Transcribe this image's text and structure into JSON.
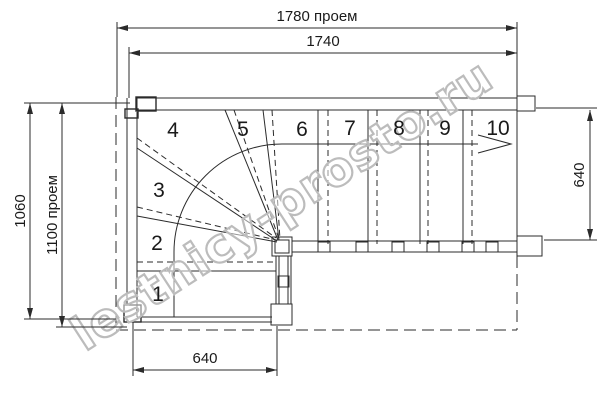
{
  "drawing": {
    "type": "staircase-floor-plan",
    "watermark": "lestnicy-prosto.ru",
    "dimensions": {
      "top_opening": "1780 проем",
      "top_inner": "1740",
      "left_height": "1060",
      "left_opening": "1100 проем",
      "right_width": "640",
      "bottom_width": "640"
    },
    "steps": [
      "1",
      "2",
      "3",
      "4",
      "5",
      "6",
      "7",
      "8",
      "9",
      "10"
    ]
  }
}
